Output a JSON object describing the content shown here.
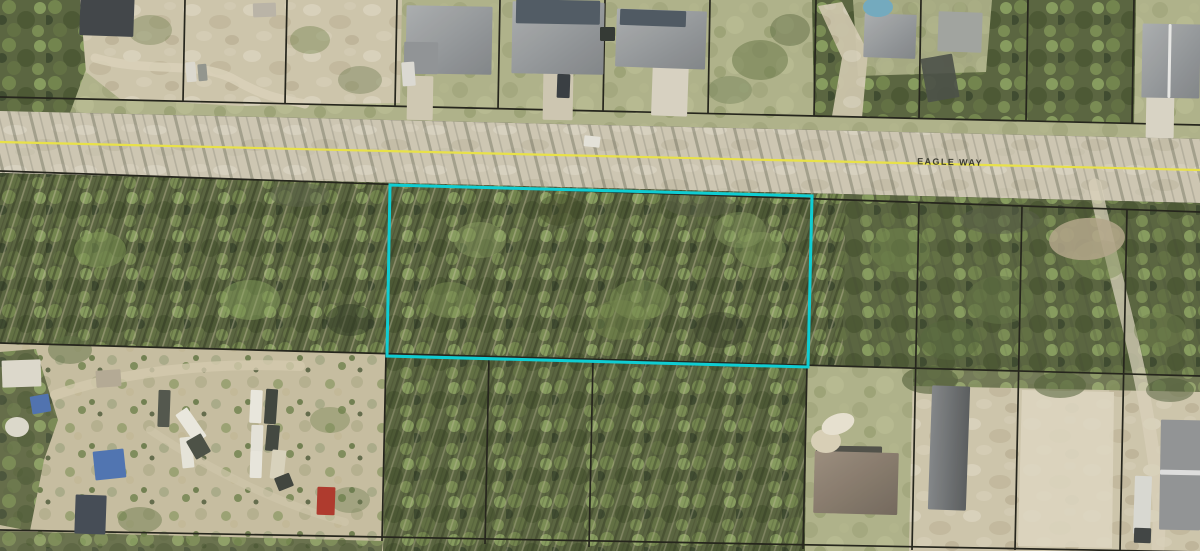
{
  "map": {
    "view": "aerial-parcel-map",
    "road": {
      "name": "EAGLE WAY",
      "label": {
        "x": 950,
        "y": 165,
        "rotation": 1.3,
        "color": "#3b3b31",
        "font_size": 9,
        "letter_spacing": 1.4
      },
      "centerline": {
        "x1": 0,
        "y1": 142,
        "x2": 1200,
        "y2": 170,
        "color": "#e9e243",
        "width": 2.2
      },
      "surface_color": "#cdc6b2"
    },
    "parcel_highlight": {
      "color": "#10cdd2",
      "width": 3,
      "points": "390,185 812,196 808,367 387,356"
    },
    "lot_line_color": "#1d1d15",
    "lot_lines": [
      [
        0,
        97,
        1200,
        125
      ],
      [
        0,
        171,
        1200,
        212
      ],
      [
        0,
        343,
        1200,
        376
      ],
      [
        0,
        530,
        1200,
        552
      ],
      [
        185,
        0,
        183,
        101
      ],
      [
        287,
        0,
        285,
        104
      ],
      [
        397,
        0,
        395,
        106
      ],
      [
        500,
        0,
        498,
        109
      ],
      [
        605,
        0,
        603,
        111
      ],
      [
        710,
        0,
        708,
        113
      ],
      [
        816,
        0,
        814,
        116
      ],
      [
        921,
        0,
        919,
        118
      ],
      [
        1028,
        0,
        1026,
        121
      ],
      [
        1134,
        0,
        1132,
        123
      ],
      [
        919,
        203,
        912,
        550
      ],
      [
        1022,
        206,
        1015,
        550
      ],
      [
        1127,
        210,
        1120,
        551
      ],
      [
        386,
        354,
        382,
        541
      ],
      [
        489,
        357,
        485,
        544
      ],
      [
        593,
        360,
        589,
        547
      ],
      [
        807,
        366,
        803,
        549
      ]
    ],
    "areas": [
      {
        "n": "north-lots-lawn",
        "p": "0,0 1200,0 1200,139 0,111",
        "f": "pattern:lawn"
      },
      {
        "n": "northwest-woods",
        "p": "0,0 94,0 88,64 68,118 0,112",
        "f": "pattern:woods"
      },
      {
        "n": "north-sand-lots",
        "p": "80,0 402,0 400,103 240,106 120,99 86,72",
        "f": "pattern:sandm"
      },
      {
        "n": "northeast-woods",
        "p": "812,0 1136,0 1134,124 814,116",
        "f": "pattern:woods"
      },
      {
        "n": "northeast-clearing",
        "p": "853,0 992,0 986,72 858,76",
        "f": "pattern:lawn",
        "o": 0.9
      },
      {
        "n": "northeast-trail-clearing",
        "p": "818,6 842,2 868,52 862,118 832,116 842,58",
        "f": "pattern:sandm",
        "o": 0.95
      },
      {
        "n": "road-surface",
        "p": "0,111 1200,139 1200,203 0,173",
        "f": "pattern:roadsurf"
      },
      {
        "n": "road-tree-shadows",
        "p": "0,111 1200,139 1200,203 0,173",
        "f": "pattern:streakShadow"
      },
      {
        "n": "south-woods-band",
        "p": "0,173 1200,203 1200,376 0,343",
        "f": "pattern:woods"
      },
      {
        "n": "fallen-timber-texture",
        "p": "0,173 846,194 842,372 0,343",
        "f": "pattern:streakFallen"
      },
      {
        "n": "east-woods-shadows",
        "p": "846,194 1200,203 1200,376 842,372",
        "f": "pattern:streakShadow",
        "o": 0.6
      },
      {
        "n": "bottom-scrub-band",
        "p": "0,343 1200,376 1200,551 0,551",
        "f": "pattern:scrub"
      },
      {
        "n": "bottom-middle-woods",
        "p": "386,353 807,365 805,551 383,551",
        "f": "pattern:woods"
      },
      {
        "n": "bottom-middle-fallen",
        "p": "386,353 807,365 805,551 383,551",
        "f": "pattern:streakFallen",
        "o": 0.8
      },
      {
        "n": "bottom-left-edge-woods",
        "p": "0,352 36,349 58,420 44,460 30,531 0,525",
        "f": "pattern:woods",
        "o": 0.9
      },
      {
        "n": "bottom-left-woods-strip",
        "p": "0,531 383,541 382,551 0,551",
        "f": "pattern:woods",
        "o": 0.85
      },
      {
        "n": "grass-lot-southeast",
        "p": "807,365 913,368 909,551 805,551",
        "f": "pattern:lawn"
      },
      {
        "n": "sand-lots-southeast",
        "p": "913,368 1200,376 1200,551 909,551",
        "f": "pattern:sandm"
      },
      {
        "n": "southeast-tree-fringe",
        "p": "913,368 1200,376 1200,392 913,386",
        "f": "pattern:woods",
        "o": 0.8
      },
      {
        "n": "bright-sand-clearing",
        "p": "1022,390 1114,392 1112,548 1018,546",
        "f": "#ded6c1",
        "o": 0.85
      }
    ],
    "trails": [
      {
        "n": "dirt-trail-north",
        "d": "M95,58 C150,74 200,60 235,80 S290,100 305,104",
        "c": "#d9d1ba",
        "w": 9,
        "o": 0.85
      },
      {
        "n": "boatyard-trail-upper",
        "d": "M55,395 C120,372 210,362 300,366",
        "c": "#d3c9ad",
        "w": 10,
        "o": 0.8
      },
      {
        "n": "boatyard-trail-lower",
        "d": "M150,430 C210,470 280,505 345,522",
        "c": "#cfc5a9",
        "w": 8,
        "o": 0.7
      },
      {
        "n": "sand-strip-far-right",
        "d": "M1095,185 C1110,260 1135,340 1148,420 S1160,510 1158,548",
        "c": "#d8d0b9",
        "w": 13,
        "o": 0.75
      }
    ],
    "canopies": [
      [
        150,
        30,
        22,
        15,
        "#6d7d4a",
        0.4
      ],
      [
        310,
        40,
        20,
        14,
        "#75864f",
        0.45
      ],
      [
        360,
        80,
        22,
        14,
        "#68794a",
        0.4
      ],
      [
        760,
        60,
        28,
        20,
        "#5f7040",
        0.5
      ],
      [
        790,
        30,
        20,
        16,
        "#54643a",
        0.45
      ],
      [
        730,
        90,
        22,
        14,
        "#66774a",
        0.4
      ],
      [
        300,
        195,
        30,
        12,
        "#565d43",
        0.5
      ],
      [
        700,
        205,
        35,
        12,
        "#565d43",
        0.45
      ],
      [
        1000,
        220,
        40,
        14,
        "#515841",
        0.5
      ],
      [
        100,
        250,
        26,
        18,
        "#7d9751",
        0.5
      ],
      [
        250,
        300,
        30,
        20,
        "#88a45c",
        0.45
      ],
      [
        480,
        240,
        26,
        18,
        "#90a863",
        0.4
      ],
      [
        640,
        300,
        30,
        20,
        "#7a9150",
        0.45
      ],
      [
        760,
        250,
        26,
        18,
        "#87a15a",
        0.4
      ],
      [
        350,
        320,
        24,
        16,
        "#2c3520",
        0.5
      ],
      [
        560,
        210,
        22,
        16,
        "#36411f",
        0.4
      ],
      [
        720,
        330,
        26,
        18,
        "#2c3520",
        0.4
      ],
      [
        450,
        300,
        26,
        18,
        "#7b914f",
        0.45
      ],
      [
        620,
        320,
        30,
        20,
        "#708548",
        0.45
      ],
      [
        740,
        230,
        26,
        18,
        "#83985a",
        0.4
      ],
      [
        900,
        250,
        30,
        22,
        "#6e8348",
        0.5
      ],
      [
        1000,
        300,
        34,
        24,
        "#5d7040",
        0.5
      ],
      [
        1100,
        260,
        28,
        20,
        "#778c50",
        0.45
      ],
      [
        950,
        340,
        30,
        20,
        "#4f6136",
        0.5
      ],
      [
        1160,
        330,
        26,
        18,
        "#6a7d46",
        0.45
      ],
      [
        930,
        380,
        28,
        14,
        "#4c5c33",
        0.6
      ],
      [
        1060,
        385,
        26,
        13,
        "#4c5c33",
        0.55
      ],
      [
        1170,
        390,
        24,
        12,
        "#46552f",
        0.5
      ],
      [
        70,
        350,
        22,
        14,
        "#5a6b3d",
        0.5
      ],
      [
        330,
        420,
        20,
        13,
        "#6c7d48",
        0.4
      ],
      [
        140,
        520,
        22,
        13,
        "#5f7040",
        0.45
      ],
      [
        350,
        500,
        20,
        13,
        "#67784a",
        0.4
      ]
    ],
    "features": [
      {
        "n": "driveway-house-a",
        "t": "r",
        "x": 407,
        "y": 76,
        "w": 26,
        "h": 44,
        "r": 1,
        "f": "#cfc8b2"
      },
      {
        "n": "driveway-house-b",
        "t": "r",
        "x": 543,
        "y": 72,
        "w": 30,
        "h": 48,
        "r": 1,
        "f": "#cdc6b0"
      },
      {
        "n": "driveway-house-c",
        "t": "r",
        "x": 652,
        "y": 60,
        "w": 36,
        "h": 56,
        "r": 2,
        "f": "#d7d1c1"
      },
      {
        "n": "driveway-house-e",
        "t": "r",
        "x": 1146,
        "y": 94,
        "w": 28,
        "h": 44,
        "r": 1,
        "f": "#d9d3c4"
      },
      {
        "n": "dark-roof-house-northwest",
        "t": "r",
        "x": 80,
        "y": -8,
        "w": 54,
        "h": 44,
        "r": 2,
        "f": "#3b4044"
      },
      {
        "n": "shed-north",
        "t": "r",
        "x": 253,
        "y": 3,
        "w": 23,
        "h": 14,
        "r": -2,
        "f": "#b9b3a6"
      },
      {
        "n": "house-a-roof",
        "t": "r",
        "x": 406,
        "y": 6,
        "w": 86,
        "h": 68,
        "r": 1,
        "f": "grad:gradGray"
      },
      {
        "n": "house-a-wing",
        "t": "r",
        "x": 404,
        "y": 42,
        "w": 34,
        "h": 32,
        "r": 1,
        "f": "#8e9194"
      },
      {
        "n": "house-b-roof",
        "t": "r",
        "x": 512,
        "y": 2,
        "w": 92,
        "h": 72,
        "r": 1,
        "f": "grad:gradGray"
      },
      {
        "n": "house-b-dark-section",
        "t": "r",
        "x": 516,
        "y": 0,
        "w": 84,
        "h": 24,
        "r": 1,
        "f": "#4b5660"
      },
      {
        "n": "house-c-roof",
        "t": "r",
        "x": 616,
        "y": 10,
        "w": 90,
        "h": 58,
        "r": 2,
        "f": "grad:gradGray"
      },
      {
        "n": "house-c-dark-section",
        "t": "r",
        "x": 620,
        "y": 10,
        "w": 66,
        "h": 16,
        "r": 2,
        "f": "#49545e"
      },
      {
        "n": "shed-at-lot-line",
        "t": "r",
        "x": 600,
        "y": 27,
        "w": 15,
        "h": 14,
        "r": 0,
        "f": "#2d322e"
      },
      {
        "n": "white-car-house-a",
        "t": "r",
        "x": 402,
        "y": 62,
        "w": 13,
        "h": 24,
        "r": -4,
        "f": "#dcdad3"
      },
      {
        "n": "dark-car-house-b",
        "t": "r",
        "x": 557,
        "y": 74,
        "w": 13,
        "h": 24,
        "r": 2,
        "f": "#32373d"
      },
      {
        "n": "white-car-on-road",
        "t": "r",
        "x": 584,
        "y": 136,
        "w": 16,
        "h": 11,
        "r": 6,
        "f": "#e4e2da"
      },
      {
        "n": "parked-trailer-north-1",
        "t": "r",
        "x": 186,
        "y": 62,
        "w": 10,
        "h": 20,
        "r": -5,
        "f": "#dcd9cf"
      },
      {
        "n": "parked-trailer-north-2",
        "t": "r",
        "x": 198,
        "y": 64,
        "w": 9,
        "h": 17,
        "r": -5,
        "f": "#90938c"
      },
      {
        "n": "house-d1-roof",
        "t": "r",
        "x": 864,
        "y": 14,
        "w": 52,
        "h": 44,
        "r": 2,
        "f": "grad:gradGray"
      },
      {
        "n": "house-d2-roof",
        "t": "r",
        "x": 938,
        "y": 12,
        "w": 44,
        "h": 40,
        "r": 2,
        "f": "#9fa29e"
      },
      {
        "n": "debris-pile-northeast",
        "t": "r",
        "x": 924,
        "y": 56,
        "w": 32,
        "h": 44,
        "r": -10,
        "f": "#454a42",
        "o": 0.9
      },
      {
        "n": "swimming-pool",
        "t": "e",
        "cx": 878,
        "cy": 7,
        "rx": 15,
        "ry": 10,
        "r": 0,
        "f": "#6fa8be"
      },
      {
        "n": "house-e-roof",
        "t": "r",
        "x": 1142,
        "y": 24,
        "w": 58,
        "h": 74,
        "r": 1,
        "f": "grad:gradGray"
      },
      {
        "n": "house-e-ridge",
        "t": "r",
        "x": 1168,
        "y": 24,
        "w": 3,
        "h": 74,
        "r": 1,
        "f": "#e8e8e6"
      },
      {
        "n": "brown-house-dark-edge",
        "t": "r",
        "x": 816,
        "y": 446,
        "w": 66,
        "h": 12,
        "r": 1,
        "f": "#4b4b44"
      },
      {
        "n": "brown-roof-house-south",
        "t": "r",
        "x": 814,
        "y": 452,
        "w": 84,
        "h": 62,
        "r": 1.5,
        "f": "grad:gradBrown"
      },
      {
        "n": "pole-barn-south",
        "t": "r",
        "x": 930,
        "y": 386,
        "w": 38,
        "h": 124,
        "r": 2,
        "f": "grad:gradBarn"
      },
      {
        "n": "long-building-southeast",
        "t": "r",
        "x": 1160,
        "y": 420,
        "w": 41,
        "h": 110,
        "r": 1,
        "f": "#8f9193"
      },
      {
        "n": "long-building-ridge",
        "t": "r",
        "x": 1160,
        "y": 470,
        "w": 41,
        "h": 5,
        "r": 1,
        "f": "#dedede"
      },
      {
        "n": "box-truck",
        "t": "r",
        "x": 1134,
        "y": 476,
        "w": 17,
        "h": 58,
        "r": 2,
        "f": "#d9d8d2"
      },
      {
        "n": "box-truck-cab",
        "t": "r",
        "x": 1134,
        "y": 528,
        "w": 17,
        "h": 15,
        "r": 2,
        "f": "#3a3f3f"
      },
      {
        "n": "blue-roof-shed",
        "t": "r",
        "x": 94,
        "y": 450,
        "w": 31,
        "h": 29,
        "r": -6,
        "f": "#4a70b0"
      },
      {
        "n": "dark-mobile-home",
        "t": "r",
        "x": 75,
        "y": 495,
        "w": 31,
        "h": 39,
        "r": 2,
        "f": "#3f4651"
      },
      {
        "n": "white-trailer-west",
        "t": "r",
        "x": 2,
        "y": 360,
        "w": 39,
        "h": 27,
        "r": -2,
        "f": "#ddd8cc"
      },
      {
        "n": "tan-shed-west",
        "t": "r",
        "x": 96,
        "y": 370,
        "w": 25,
        "h": 17,
        "r": -4,
        "f": "#b3a893"
      },
      {
        "n": "blue-tarp",
        "t": "r",
        "x": 31,
        "y": 395,
        "w": 19,
        "h": 18,
        "r": -10,
        "f": "#4a6eae"
      },
      {
        "n": "white-dish",
        "t": "e",
        "cx": 17,
        "cy": 427,
        "rx": 12,
        "ry": 10,
        "r": 0,
        "f": "#dcd8cb"
      },
      {
        "n": "dark-trailer-boatyard",
        "t": "r",
        "x": 158,
        "y": 390,
        "w": 12,
        "h": 37,
        "r": 2,
        "f": "#4d5248"
      },
      {
        "n": "red-container",
        "t": "r",
        "x": 317,
        "y": 487,
        "w": 18,
        "h": 28,
        "r": 2,
        "f": "#ad3326"
      },
      {
        "n": "sand-circle-patch",
        "t": "e",
        "cx": 826,
        "cy": 441,
        "rx": 15,
        "ry": 12,
        "r": 0,
        "f": "#d8cfb6"
      },
      {
        "n": "white-debris-patch",
        "t": "e",
        "cx": 838,
        "cy": 424,
        "rx": 17,
        "ry": 10,
        "r": -20,
        "f": "#e7e1d0"
      },
      {
        "n": "dirt-clearing-east",
        "t": "e",
        "cx": 1087,
        "cy": 239,
        "rx": 38,
        "ry": 21,
        "r": -4,
        "f": "#b2a387",
        "o": 0.85
      },
      {
        "n": "boat-1",
        "t": "r",
        "x": 184,
        "y": 408,
        "w": 14,
        "h": 35,
        "r": -35,
        "f": "#eae8df"
      },
      {
        "n": "boat-2",
        "t": "r",
        "x": 181,
        "y": 437,
        "w": 12,
        "h": 31,
        "r": -6,
        "f": "#e6e4da"
      },
      {
        "n": "boat-shadow",
        "t": "r",
        "x": 190,
        "y": 436,
        "w": 17,
        "h": 21,
        "r": -30,
        "f": "#464b41"
      },
      {
        "n": "boat-3",
        "t": "r",
        "x": 250,
        "y": 390,
        "w": 12,
        "h": 33,
        "r": 3,
        "f": "#e9e7de"
      },
      {
        "n": "boat-4",
        "t": "r",
        "x": 265,
        "y": 389,
        "w": 12,
        "h": 35,
        "r": 4,
        "f": "#3a4038"
      },
      {
        "n": "boat-5",
        "t": "r",
        "x": 251,
        "y": 425,
        "w": 12,
        "h": 27,
        "r": 2,
        "f": "#e4e2d8"
      },
      {
        "n": "boat-6",
        "t": "r",
        "x": 266,
        "y": 425,
        "w": 13,
        "h": 26,
        "r": 5,
        "f": "#3d423a"
      },
      {
        "n": "boat-7",
        "t": "r",
        "x": 250,
        "y": 451,
        "w": 12,
        "h": 27,
        "r": 2,
        "f": "#e8e6dd"
      },
      {
        "n": "boat-8",
        "t": "r",
        "x": 271,
        "y": 450,
        "w": 14,
        "h": 29,
        "r": 6,
        "f": "#d9d2bc"
      },
      {
        "n": "boat-9",
        "t": "r",
        "x": 276,
        "y": 475,
        "w": 16,
        "h": 14,
        "r": -22,
        "f": "#3a3f38"
      }
    ]
  }
}
